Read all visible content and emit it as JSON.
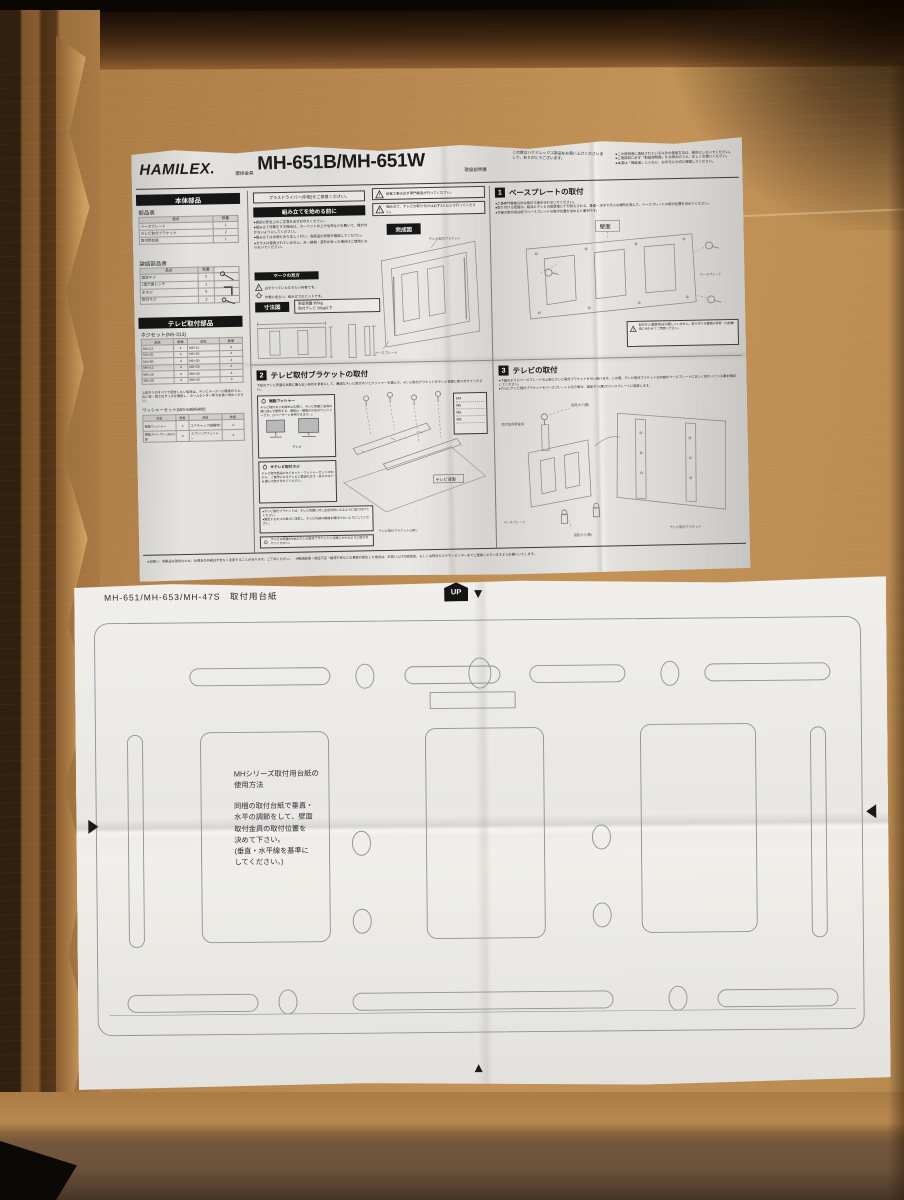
{
  "colors": {
    "cardboard": "#b5854e",
    "cardboard_shadow": "#2a1708",
    "manual_paper": "#dddcd8",
    "template_paper": "#eae9e5",
    "ink": "#1b1b1b",
    "header_bar": "#161616"
  },
  "manual": {
    "brand": "HAMILEX.",
    "category": "壁掛金具",
    "model": "MH-651B/MH-651W",
    "doc_type": "取扱説明書",
    "greeting": "この度はハヤミレックス製品をお買い上げくださいまして、ありがとうございます。",
    "header_notes": [
      "●この説明書に表記されている以外の使用方法は、絶対にしないでください。",
      "●ご使用前に必ず「取扱説明書」をお読みのうえ、正しくお使いください。",
      "●本書は「保証書」とともに、お手元に大切に保管してください。"
    ],
    "left": {
      "body_parts_header": "本体部品",
      "parts_title": "部品表",
      "col_name": "品名",
      "col_qty": "数量",
      "parts_rows": [
        [
          "ベースプレート",
          "1"
        ],
        [
          "テレビ取付ブラケット",
          "2"
        ],
        [
          "取付用台紙",
          "1"
        ]
      ],
      "bag_title": "袋詰部品表",
      "bag_rows": [
        [
          "固定ネジ",
          "2"
        ],
        [
          "L型六角レンチ",
          "1"
        ],
        [
          "木ネジ",
          "6"
        ],
        [
          "取付ネジ",
          "2"
        ]
      ],
      "tv_parts_header": "テレビ取付部品",
      "screw_title": "ネジセット(NS-313)",
      "screw_rows": [
        [
          "M4×12",
          "4",
          "M6×12",
          "4"
        ],
        [
          "M4×20",
          "4",
          "M6×20",
          "4"
        ],
        [
          "M4×30",
          "4",
          "M6×30",
          "4"
        ],
        [
          "M5×12",
          "4",
          "M8×20",
          "4"
        ],
        [
          "M5×20",
          "4",
          "M8×30",
          "4"
        ],
        [
          "M5×30",
          "4",
          "M8×45",
          "4"
        ]
      ],
      "screw_note": "上記ネジのすべてで適合しない場合は、テレビメーカーに確認のうえ、ねじ径・長さのサイズを確認し、ホームセンター等でお買い求めください。",
      "washer_title": "ワッシャーセット(WS-64B/64W)",
      "washer_rows": [
        [
          "樹脂ワッシャー",
          "4",
          "エアキャップ(緩衝材)",
          "4"
        ],
        [
          "樹脂スペーサー15mm厚",
          "4",
          "スプリングワッシャー",
          "4"
        ]
      ]
    },
    "mid": {
      "driver_note": "プラスドライバー(中型)をご用意ください。",
      "before_header": "組み立てを始める前に",
      "before_bullets": [
        "●表記の安全上のご注意を必ずお守りください。",
        "●組み立て作業をする場合は、カーペットの上や毛布などを敷いて、傷が付かないようにしてください。",
        "●組み立ては手順どおり正しく行い、各部品の状態を確認してください。",
        "●ガラスは使用されていません。万一破損・変形があった場合はご使用にならないでください。"
      ],
      "marks_header": "マークの見方",
      "mark_must": "必ずやっていただきたい内容です。",
      "mark_tip": "作業に役立つ、組み立てのヒントです。",
      "dim_header": "寸法図",
      "spec_line1": "製品質量 約5kg",
      "spec_line2": "取付テレビ 50kg以下",
      "warning1": "設置工事は必ず専門業者が行ってください。",
      "warning2": "組み立て、テレビの取り付けは必ず2人以上で行ってください。",
      "finished_header": "完成図",
      "finished_label_bracket": "テレビ取付ブラケット",
      "finished_label_plate": "ベースプレート"
    },
    "s1": {
      "num": "1",
      "title": "ベースプレートの取付",
      "bullets": [
        "●工事専門業者以外は取付工事を行わないでください。",
        "●取り付ける壁面は、製品とテレビの総質量に十分耐えられる、垂直・水平で平らな場所を選んで、ベースプレートの取付位置を決めてください。",
        "●付属の取付用台紙でベースプレートの取付位置を決めると便利です。"
      ],
      "wall_label": "壁面",
      "plate_label": "ベースプレート",
      "caution": "取付ネジ(壁面用)は付属していません。取り付ける壁面の材質・内部構造に合わせてご用意ください。"
    },
    "s2": {
      "num": "2",
      "title": "テレビ取付ブラケットの取付",
      "intro": "下記のテレビ背面の状態に最も近い形状を参考にして、最適なテレビ取付ネジとワッシャーを選んで、テレビ取付ブラケットをテレビ背面に取り付けてください。",
      "tip1_title": "樹脂ワッシャー",
      "tip1_body": "テレビ取付ネジを締め込む際に、テレビ背面と金具の間に挟んで使用する、傷防止・補強のためのワッシャーです。(スペーサーと併用できます。)",
      "tv_label": "テレビ",
      "back_label": "テレビ背面",
      "screw_sizes": [
        "M4",
        "M5",
        "M6",
        "M8"
      ],
      "tip2_title": "※テレビ取付ネジ",
      "tip2_body": "テレビ取付部品のネジセット・ワッシャーセットの中から、ご使用になるテレビに最適な太さ・長さのネジを選んで取り付けてください。",
      "notes": [
        "●テレビ取付ブラケットは、テレビ背面に対し左右対称になるように取り付けてください。",
        "●固定するネジの長さに注意し、テレビ内部の機器を傷付けないようにしてください。"
      ],
      "bottom_tip": "テレビの荷重が2本のテレビ取付ブラケットに均等にかかるように取り付けてください。",
      "bracket_label": "テレビ取付ブラケット(2本)"
    },
    "s3": {
      "num": "3",
      "title": "テレビの取付",
      "bullets": [
        "●下図のようにベースプレートの上部にテレビ取付ブラケットを引っ掛けます。この際、テレビ取付ブラケットの内側がベースプレートに正しく掛かっている事を確認してください。",
        "●さらにテレビ取付ブラケットをベースプレートに引き寄せ、固定ネジ(黒)でベースプレートに固定します。"
      ],
      "label_hook": "取付金具受金具",
      "label_screw_top": "固定ネジ(黒)",
      "label_plate": "ベースプレート",
      "label_bracket": "テレビ取付ブラケット",
      "label_screw_bottom": "固定ネジ(黒)"
    },
    "footer_note": "●お願い：本製品は改良のため、仕様及び外観は予告なく変更することがあります。ご了承ください。　※輸送破損・部品不足・製造不良などの事故が発生した場合は、お買い上げの販売店、もしくは弊社カスタマーセンターまでご連絡くださいますようお願いいたします。"
  },
  "template_sheet": {
    "label": "MH-651/MH-653/MH-47S　取付用台紙",
    "up": "UP",
    "usage_title_l1": "MHシリーズ取付用台紙の",
    "usage_title_l2": "使用方法",
    "usage_lines": [
      "同梱の取付台紙で垂直・",
      "水平の調節をして、壁面",
      "取付金具の取付位置を",
      "決めて下さい。",
      "(垂直・水平線を基準に",
      "してください。)"
    ]
  }
}
